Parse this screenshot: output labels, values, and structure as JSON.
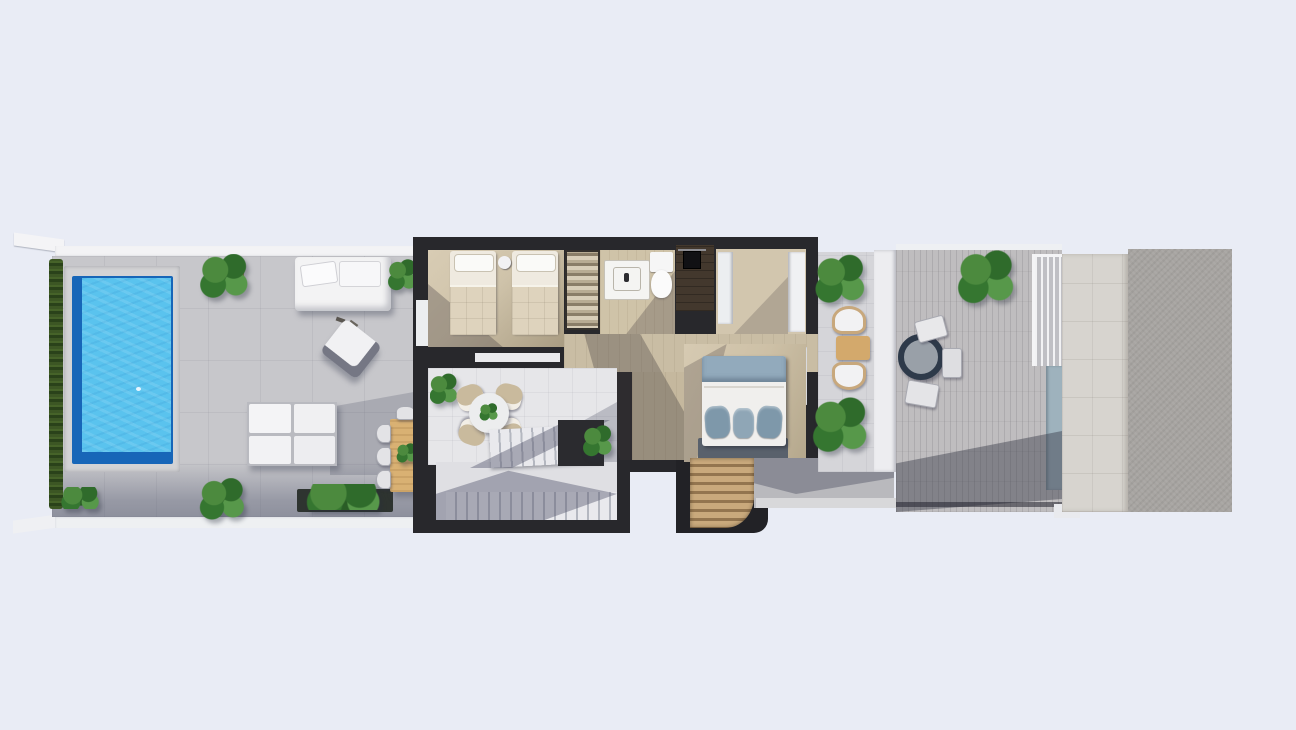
{
  "scene": {
    "kind": "architectural 3D floor plan, top-down render",
    "floor": "upper floor of a villa with pool terrace",
    "background_color": "#e9ecf5",
    "no_visible_text": true
  },
  "palette": {
    "background": "#e9ecf5",
    "wall_white": "#f2f3f5",
    "wall_dark": "#28282c",
    "deck_tile": "#c7c7cb",
    "hedge_green": "#3a5424",
    "pool_deep_blue": "#1766b8",
    "pool_water_blue": "#5ac3ee",
    "wood_floor": "#cfc3aa",
    "living_tile": "#e6e6e9",
    "balcony_tile": "#d5d5d9",
    "right_terrace_tile": "#bfbdbf",
    "stone_path": "#d7d4cf",
    "concrete_pad": "#a7a4a1",
    "pergola_wood": "#c8a87a",
    "table_wood": "#d9b173",
    "master_blanket_blue": "#92aabc",
    "railing_blue": "#9eb2bd"
  },
  "pool_terrace": {
    "name": "pool terrace",
    "features": [
      "privacy hedge",
      "swimming pool",
      "sun daybed",
      "lounge armchair",
      "sectional sofa",
      "wooden outdoor dining table with chairs",
      "long planter box",
      "potted plants"
    ]
  },
  "house": {
    "rooms": [
      {
        "name": "twin bedroom",
        "furniture": [
          "single bed",
          "single bed",
          "nightstand",
          "open wardrobe"
        ]
      },
      {
        "name": "bathroom",
        "furniture": [
          "vanity sink",
          "toilet"
        ]
      },
      {
        "name": "shower room",
        "furniture": [
          "walk-in shower"
        ]
      },
      {
        "name": "walk-in closet",
        "furniture": [
          "white wardrobe panels"
        ]
      },
      {
        "name": "hallway",
        "furniture": []
      },
      {
        "name": "master bedroom",
        "furniture": [
          "double bed with blue bedding",
          "foot bench"
        ]
      },
      {
        "name": "living area",
        "furniture": [
          "round table",
          "four wicker chairs",
          "potted plant"
        ]
      },
      {
        "name": "staircase",
        "furniture": [
          "upper flight",
          "lower flight",
          "landing"
        ]
      },
      {
        "name": "entry pergola",
        "furniture": [
          "wood slat canopy"
        ]
      }
    ]
  },
  "balcony": {
    "name": "side balcony",
    "features": [
      "two rattan chairs",
      "small wooden table",
      "two potted plants"
    ]
  },
  "right_terrace": {
    "name": "roof terrace",
    "features": [
      "round bistro table",
      "three chairs",
      "potted plant in wooden planter",
      "glass railing",
      "blue-grey railing panel"
    ]
  },
  "far_right": {
    "name": "side yard",
    "features": [
      "stone paving strip",
      "textured concrete pad"
    ]
  }
}
